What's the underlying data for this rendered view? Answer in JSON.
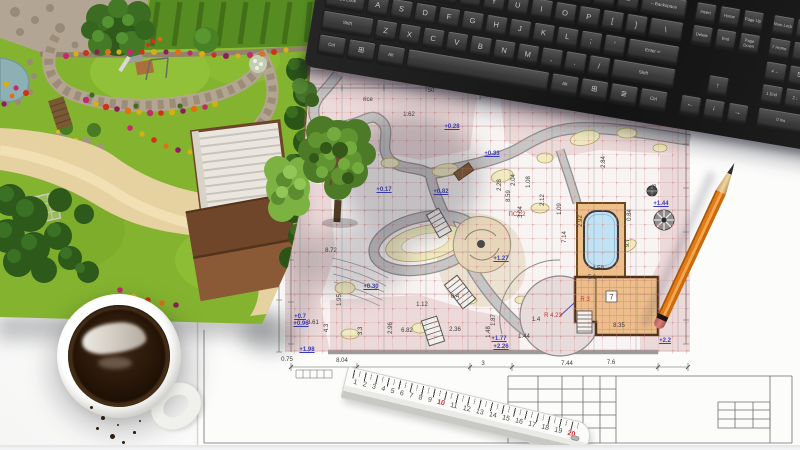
{
  "keyboard": {
    "main_rows": [
      [
        "`",
        "1",
        "2",
        "3",
        "4",
        "5",
        "6",
        "7",
        "8",
        "9",
        "0",
        "-",
        "=",
        "←Backspace"
      ],
      [
        "Tab",
        "Q",
        "W",
        "E",
        "R",
        "T",
        "Y",
        "U",
        "I",
        "O",
        "P",
        "[",
        "]",
        "\\"
      ],
      [
        "Caps Lock",
        "A",
        "S",
        "D",
        "F",
        "G",
        "H",
        "J",
        "K",
        "L",
        ";",
        "'",
        "Enter ↵"
      ],
      [
        "Shift",
        "Z",
        "X",
        "C",
        "V",
        "B",
        "N",
        "M",
        ",",
        ".",
        "/",
        "Shift"
      ],
      [
        "Ctrl",
        "⊞",
        "Alt",
        "",
        "Alt",
        "⊞",
        "≣",
        "Ctrl"
      ]
    ],
    "nav_rows": [
      [
        "Insert",
        "Home",
        "Page Up"
      ],
      [
        "Delete",
        "End",
        "Page Down"
      ]
    ],
    "arrows": [
      "↑",
      "←",
      "↓",
      "→"
    ],
    "numpad_rows": [
      [
        "Num Lock",
        "/",
        "*",
        "-"
      ],
      [
        "7 Home",
        "8 ↑",
        "9 PgUp",
        "+"
      ],
      [
        "4 ←",
        "5",
        "6 →",
        "+"
      ],
      [
        "1 End",
        "2 ↓",
        "3 PgDn",
        "Enter"
      ],
      [
        "0 Ins",
        ". Del",
        "Enter"
      ]
    ]
  },
  "ruler": {
    "unit_numbers": [
      "1",
      "2",
      "3",
      "4",
      "5",
      "6",
      "7",
      "8",
      "9",
      "10",
      "11",
      "12",
      "13",
      "14",
      "15",
      "16",
      "17",
      "18",
      "19",
      "20"
    ],
    "red_numbers": [
      "10",
      "20"
    ]
  },
  "blueprint": {
    "room_number": "7",
    "labels": [
      {
        "t": "+0.02",
        "x": 360,
        "y": 130,
        "c": "b"
      },
      {
        "t": "+0.28",
        "x": 452,
        "y": 127,
        "c": "b"
      },
      {
        "t": "+0.33",
        "x": 492,
        "y": 154,
        "c": "b"
      },
      {
        "t": "+0.17",
        "x": 384,
        "y": 190,
        "c": "b"
      },
      {
        "t": "+0.82",
        "x": 441,
        "y": 192,
        "c": "b"
      },
      {
        "t": "+0.30",
        "x": 371,
        "y": 287,
        "c": "b"
      },
      {
        "t": "+0.7",
        "x": 300,
        "y": 317,
        "c": "b"
      },
      {
        "t": "+0.96",
        "x": 301,
        "y": 324,
        "c": "b"
      },
      {
        "t": "+1.98",
        "x": 307,
        "y": 350,
        "c": "b"
      },
      {
        "t": "+1.27",
        "x": 501,
        "y": 259,
        "c": "b"
      },
      {
        "t": "+1.77",
        "x": 499,
        "y": 339,
        "c": "b"
      },
      {
        "t": "+2.26",
        "x": 501,
        "y": 347,
        "c": "b"
      },
      {
        "t": "+1.44",
        "x": 661,
        "y": 204,
        "c": "b"
      },
      {
        "t": "+2.2",
        "x": 665,
        "y": 341,
        "c": "b"
      },
      {
        "t": "R 4.23",
        "x": 553,
        "y": 316,
        "c": "r"
      },
      {
        "t": "R 3",
        "x": 585,
        "y": 300,
        "c": "r"
      },
      {
        "t": "ПС2.2",
        "x": 517,
        "y": 215,
        "c": "r"
      },
      {
        "t": "rice",
        "x": 368,
        "y": 100,
        "c": "d"
      },
      {
        "t": "1.62",
        "x": 409,
        "y": 115,
        "c": "d"
      },
      {
        "t": "50",
        "x": 431,
        "y": 91,
        "c": "d"
      },
      {
        "t": "8.72",
        "x": 331,
        "y": 251,
        "c": "d"
      },
      {
        "t": "3.61",
        "x": 313,
        "y": 323,
        "c": "d"
      },
      {
        "t": "0.75",
        "x": 287,
        "y": 360,
        "c": "d"
      },
      {
        "t": "8.04",
        "x": 342,
        "y": 361,
        "c": "d"
      },
      {
        "t": "3",
        "x": 483,
        "y": 364,
        "c": "d"
      },
      {
        "t": "7.44",
        "x": 567,
        "y": 364,
        "c": "d"
      },
      {
        "t": "7.6",
        "x": 611,
        "y": 363,
        "c": "d"
      },
      {
        "t": "4.59",
        "x": 598,
        "y": 269,
        "c": "d"
      },
      {
        "t": "5.6",
        "x": 592,
        "y": 278,
        "c": "d"
      },
      {
        "t": "8.35",
        "x": 619,
        "y": 326,
        "c": "d"
      },
      {
        "t": "6.82",
        "x": 407,
        "y": 331,
        "c": "d"
      },
      {
        "t": "1.12",
        "x": 422,
        "y": 305,
        "c": "d"
      },
      {
        "t": "0.4",
        "x": 455,
        "y": 297,
        "c": "d"
      },
      {
        "t": "2.36",
        "x": 455,
        "y": 330,
        "c": "d"
      },
      {
        "t": "1.4",
        "x": 536,
        "y": 320,
        "c": "d"
      },
      {
        "t": "1.44",
        "x": 524,
        "y": 337,
        "c": "d"
      },
      {
        "t": "4.3",
        "x": 327,
        "y": 328,
        "c": "d",
        "v": 1
      },
      {
        "t": "3.3",
        "x": 361,
        "y": 331,
        "c": "d",
        "v": 1
      },
      {
        "t": "2.96",
        "x": 391,
        "y": 328,
        "c": "d",
        "v": 1
      },
      {
        "t": "8.59",
        "x": 509,
        "y": 196,
        "c": "d",
        "v": 1
      },
      {
        "t": "3.04",
        "x": 521,
        "y": 212,
        "c": "d",
        "v": 1
      },
      {
        "t": "2.92",
        "x": 581,
        "y": 221,
        "c": "d",
        "v": 1
      },
      {
        "t": "7.14",
        "x": 565,
        "y": 237,
        "c": "d",
        "v": 1
      },
      {
        "t": "1.09",
        "x": 560,
        "y": 209,
        "c": "d",
        "v": 1
      },
      {
        "t": "9.7",
        "x": 628,
        "y": 243,
        "c": "d",
        "v": 1
      },
      {
        "t": "0.84",
        "x": 630,
        "y": 215,
        "c": "d",
        "v": 1
      },
      {
        "t": "2.7",
        "x": 651,
        "y": 115,
        "c": "d",
        "v": 1
      },
      {
        "t": "1.18",
        "x": 655,
        "y": 190,
        "c": "d",
        "v": 1
      },
      {
        "t": "2.84",
        "x": 604,
        "y": 162,
        "c": "d",
        "v": 1
      },
      {
        "t": "2.12",
        "x": 543,
        "y": 200,
        "c": "d",
        "v": 1
      },
      {
        "t": "1.08",
        "x": 529,
        "y": 182,
        "c": "d",
        "v": 1
      },
      {
        "t": "2.04",
        "x": 514,
        "y": 180,
        "c": "d",
        "v": 1
      },
      {
        "t": "2.28",
        "x": 500,
        "y": 185,
        "c": "d",
        "v": 1
      },
      {
        "t": "1.95",
        "x": 340,
        "y": 300,
        "c": "d",
        "v": 1
      },
      {
        "t": "1.87",
        "x": 494,
        "y": 320,
        "c": "d",
        "v": 1
      },
      {
        "t": "1.48",
        "x": 489,
        "y": 332,
        "c": "d",
        "v": 1
      }
    ],
    "colors": {
      "grid_red": "#cf8b8b",
      "zone_pink": "#ecd9d9",
      "zone_yellow": "#f0ebc0",
      "path_gray": "#c2c2c2",
      "pool_blue": "#bfe2f4",
      "deck_orange": "#eec088",
      "building_tan": "#ecbe8a",
      "elevation_blue": "#3b3bbe",
      "radius_red": "#bb3333"
    }
  },
  "rendering": {
    "colors": {
      "grass": "#84b42f",
      "sand_path": "#e6d2a0",
      "stone": "#b3a594",
      "conifer": "#2d5a1b",
      "roof_dark": "#6f462a",
      "roof_light": "#8a5a36",
      "flower_magenta": "#c22a6e",
      "flower_yellow": "#d4b012",
      "flower_red": "#cc3318",
      "pond": "#8cb0b4"
    }
  },
  "pencil": {
    "body_color": "#e07c15"
  },
  "cup": {
    "coffee_color": "#241408"
  }
}
